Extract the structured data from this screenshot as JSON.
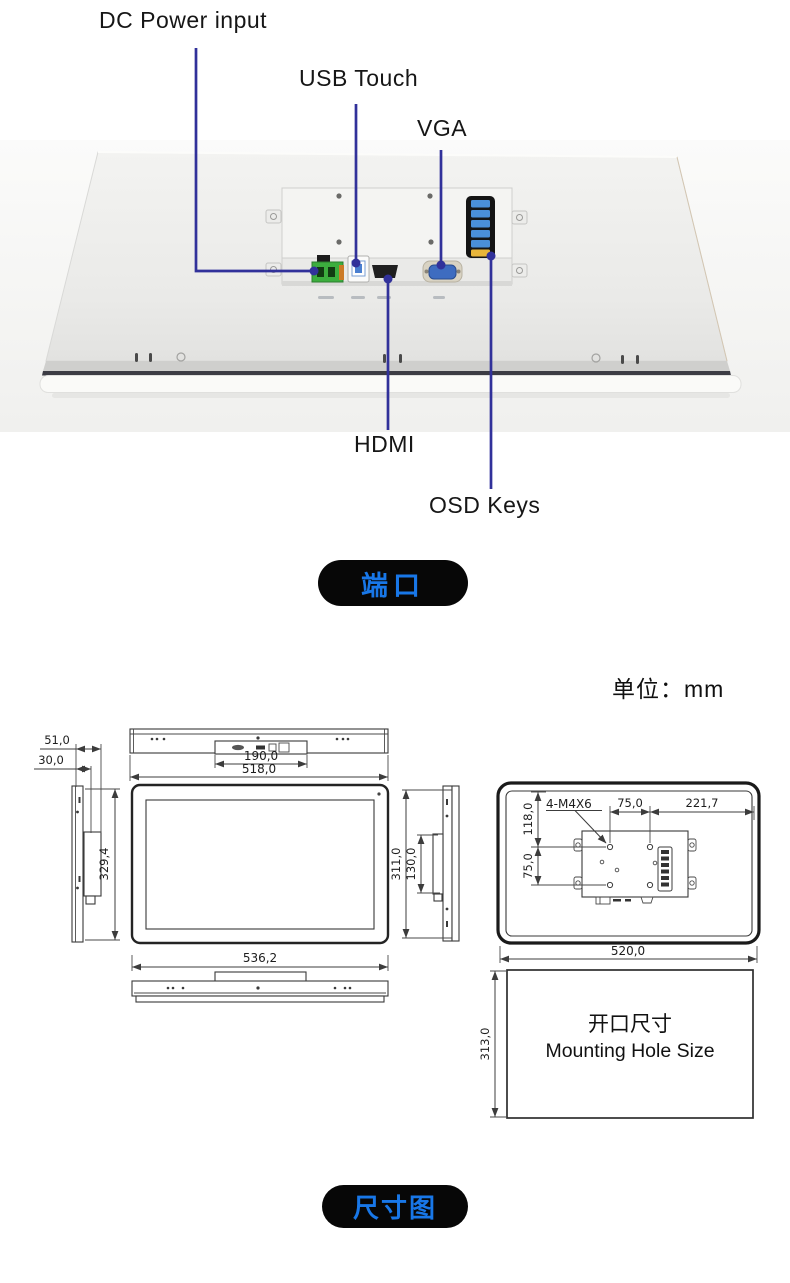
{
  "ports_section": {
    "labels": {
      "dc": "DC Power input",
      "usb": "USB Touch",
      "vga": "VGA",
      "hdmi": "HDMI",
      "osd": "OSD Keys"
    },
    "badge": "端口"
  },
  "dim_section": {
    "unit": "单位：mm",
    "badge": "尺寸图",
    "side_left": {
      "depth_total": "51,0",
      "depth_front": "30,0",
      "height": "329,4"
    },
    "top_view": {
      "connector_width": "190,0",
      "width": "518,0"
    },
    "front_view": {
      "width": "536,2"
    },
    "side_right": {
      "height": "311,0",
      "plate_height": "130,0"
    },
    "rear": {
      "screw_label": "4-M4X6",
      "top_offset": "118,0",
      "hole_dx": "75,0",
      "right_offset": "221,7",
      "hole_dy": "75,0",
      "width": "520,0"
    },
    "cutout": {
      "height": "313,0",
      "title_cn": "开口尺寸",
      "title_en": "Mounting Hole Size"
    }
  },
  "colors": {
    "accent_blue": "#1877E8",
    "leader_line": "#31319A",
    "badge_bg": "#070707"
  }
}
